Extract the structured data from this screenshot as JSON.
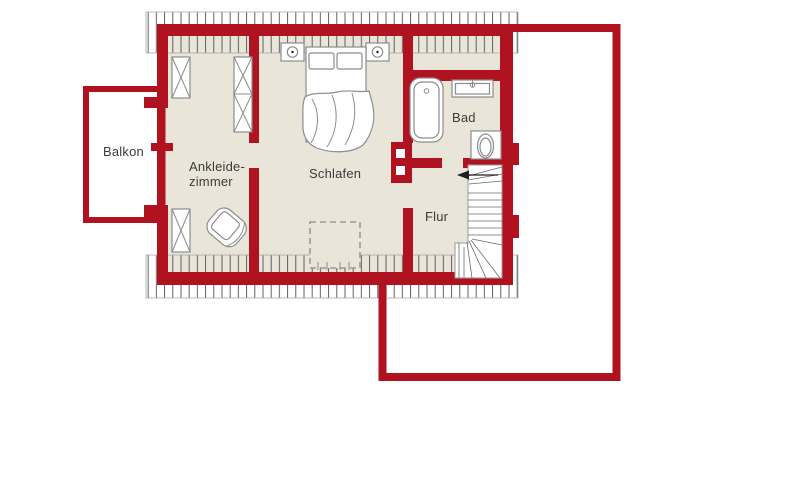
{
  "floor_plan": {
    "type": "architectural-floor-plan-upper-storey",
    "rooms": [
      {
        "name": "balkon",
        "label": "Balkon"
      },
      {
        "name": "ankleidezimmer",
        "label_lines": [
          "Ankleide-",
          "zimmer"
        ]
      },
      {
        "name": "schlafen",
        "label": "Schlafen"
      },
      {
        "name": "bad",
        "label": "Bad"
      },
      {
        "name": "flur",
        "label": "Flur"
      }
    ],
    "furniture": [
      "double-bed",
      "nightstand",
      "nightstand",
      "wardrobe",
      "wardrobe",
      "wardrobe",
      "armchair",
      "bathtub",
      "washbasin",
      "toilet",
      "winder-staircase",
      "stair-direction-arrow",
      "skylight-dashed-marker"
    ],
    "colors": {
      "wall_red": "#b01220",
      "floor_beige": "#e9e5d9",
      "balcony_white": "#ffffff",
      "hatch_gray": "#4f4f4f",
      "furniture_gray": "#8c8c8c",
      "label_text": "#3b3b3b",
      "background": "#ffffff"
    }
  }
}
